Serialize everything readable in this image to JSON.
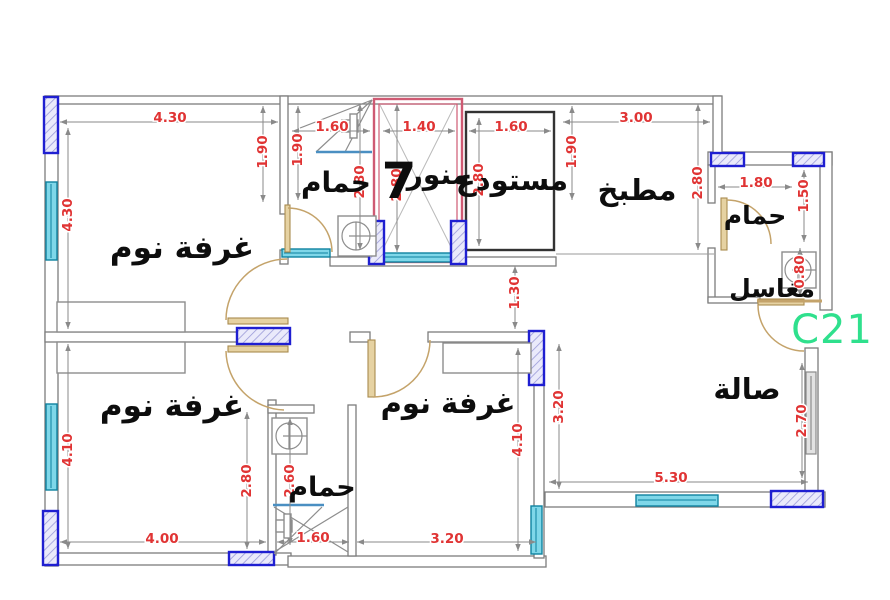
{
  "drawing_type": "apartment floor plan",
  "watermark": {
    "text": "C21",
    "color": "#2fe08d"
  },
  "palette": {
    "dimension_text": "#e03434",
    "wall": "#7d7d7d",
    "column_border": "#1f1fd1",
    "window_fill": "#7fd7e9",
    "door": "#c4a36a",
    "lightwell_outline": "#cf5a73",
    "shower_line": "#4a8fc2",
    "label_text": "#0d0d0d"
  },
  "room_labels": [
    {
      "name": "bedroom-top-left",
      "text": "غرفة نوم",
      "x": 182,
      "y": 258,
      "size": 31
    },
    {
      "name": "bathroom-top",
      "text": "حمام",
      "x": 336,
      "y": 192,
      "size": 28
    },
    {
      "name": "lightwell-number",
      "text": "7",
      "x": 399,
      "y": 198,
      "size": 50
    },
    {
      "name": "lightwell",
      "text": "منور",
      "x": 438,
      "y": 184,
      "size": 28
    },
    {
      "name": "storage",
      "text": "مستودع",
      "x": 512,
      "y": 190,
      "size": 29
    },
    {
      "name": "kitchen",
      "text": "مطبخ",
      "x": 637,
      "y": 200,
      "size": 29
    },
    {
      "name": "bathroom-top-right",
      "text": "حمام",
      "x": 755,
      "y": 224,
      "size": 25
    },
    {
      "name": "sinks",
      "text": "مغاسل",
      "x": 772,
      "y": 297,
      "size": 25
    },
    {
      "name": "hall",
      "text": "صالة",
      "x": 747,
      "y": 399,
      "size": 29
    },
    {
      "name": "bedroom-bottom-left",
      "text": "غرفة نوم",
      "x": 172,
      "y": 416,
      "size": 31
    },
    {
      "name": "bedroom-bottom-middle",
      "text": "غرفة نوم",
      "x": 448,
      "y": 413,
      "size": 29
    },
    {
      "name": "bathroom-bottom",
      "text": "حمام",
      "x": 322,
      "y": 496,
      "size": 27
    }
  ],
  "dimensions": [
    {
      "name": "bedroom-top-left-width",
      "value": "4.30",
      "x": 170,
      "y": 118,
      "rot": 0
    },
    {
      "name": "bathroom-top-width",
      "value": "1.60",
      "x": 332,
      "y": 127,
      "rot": 0
    },
    {
      "name": "lightwell-width",
      "value": "1.40",
      "x": 419,
      "y": 127,
      "rot": 0
    },
    {
      "name": "storage-width",
      "value": "1.60",
      "x": 511,
      "y": 127,
      "rot": 0
    },
    {
      "name": "kitchen-width",
      "value": "3.00",
      "x": 636,
      "y": 118,
      "rot": 0
    },
    {
      "name": "bathroom-right-width",
      "value": "1.80",
      "x": 756,
      "y": 183,
      "rot": 0
    },
    {
      "name": "hall-width",
      "value": "5.30",
      "x": 671,
      "y": 478,
      "rot": 0
    },
    {
      "name": "bedroom-bottom-left-width",
      "value": "4.00",
      "x": 162,
      "y": 539,
      "rot": 0
    },
    {
      "name": "bathroom-bottom-width",
      "value": "1.60",
      "x": 313,
      "y": 538,
      "rot": 0
    },
    {
      "name": "bedroom-bottom-mid-width",
      "value": "3.20",
      "x": 447,
      "y": 539,
      "rot": 0
    },
    {
      "name": "bedroom-top-left-height",
      "value": "4.30",
      "x": 68,
      "y": 215,
      "rot": -90
    },
    {
      "name": "bedroom-bottom-left-height",
      "value": "4.10",
      "x": 68,
      "y": 450,
      "rot": -90
    },
    {
      "name": "bedroom-door-offset",
      "value": "1.90",
      "x": 263,
      "y": 152,
      "rot": -90
    },
    {
      "name": "bathroom-top-depth",
      "value": "1.90",
      "x": 298,
      "y": 150,
      "rot": -90
    },
    {
      "name": "bathroom-top-height",
      "value": "2.80",
      "x": 360,
      "y": 182,
      "rot": -90
    },
    {
      "name": "lightwell-height",
      "value": "2.80",
      "x": 397,
      "y": 185,
      "rot": -90
    },
    {
      "name": "storage-height",
      "value": "2.80",
      "x": 479,
      "y": 180,
      "rot": -90
    },
    {
      "name": "kitchen-depth",
      "value": "1.90",
      "x": 572,
      "y": 152,
      "rot": -90
    },
    {
      "name": "kitchen-height",
      "value": "2.80",
      "x": 698,
      "y": 183,
      "rot": -90
    },
    {
      "name": "bathroom-right-height",
      "value": "1.50",
      "x": 804,
      "y": 196,
      "rot": -90
    },
    {
      "name": "sinks-height",
      "value": "0.80",
      "x": 800,
      "y": 272,
      "rot": -90
    },
    {
      "name": "corridor-width",
      "value": "1.30",
      "x": 515,
      "y": 293,
      "rot": -90
    },
    {
      "name": "hall-left-height",
      "value": "3.20",
      "x": 559,
      "y": 407,
      "rot": -90
    },
    {
      "name": "hall-right-height",
      "value": "2.70",
      "x": 802,
      "y": 421,
      "rot": -90
    },
    {
      "name": "bedroom-bottom-mid-height",
      "value": "4.10",
      "x": 518,
      "y": 440,
      "rot": -90
    },
    {
      "name": "bathroom-bottom-offset",
      "value": "2.80",
      "x": 247,
      "y": 481,
      "rot": -90
    },
    {
      "name": "bathroom-bottom-height",
      "value": "2.60",
      "x": 290,
      "y": 481,
      "rot": -90
    }
  ]
}
